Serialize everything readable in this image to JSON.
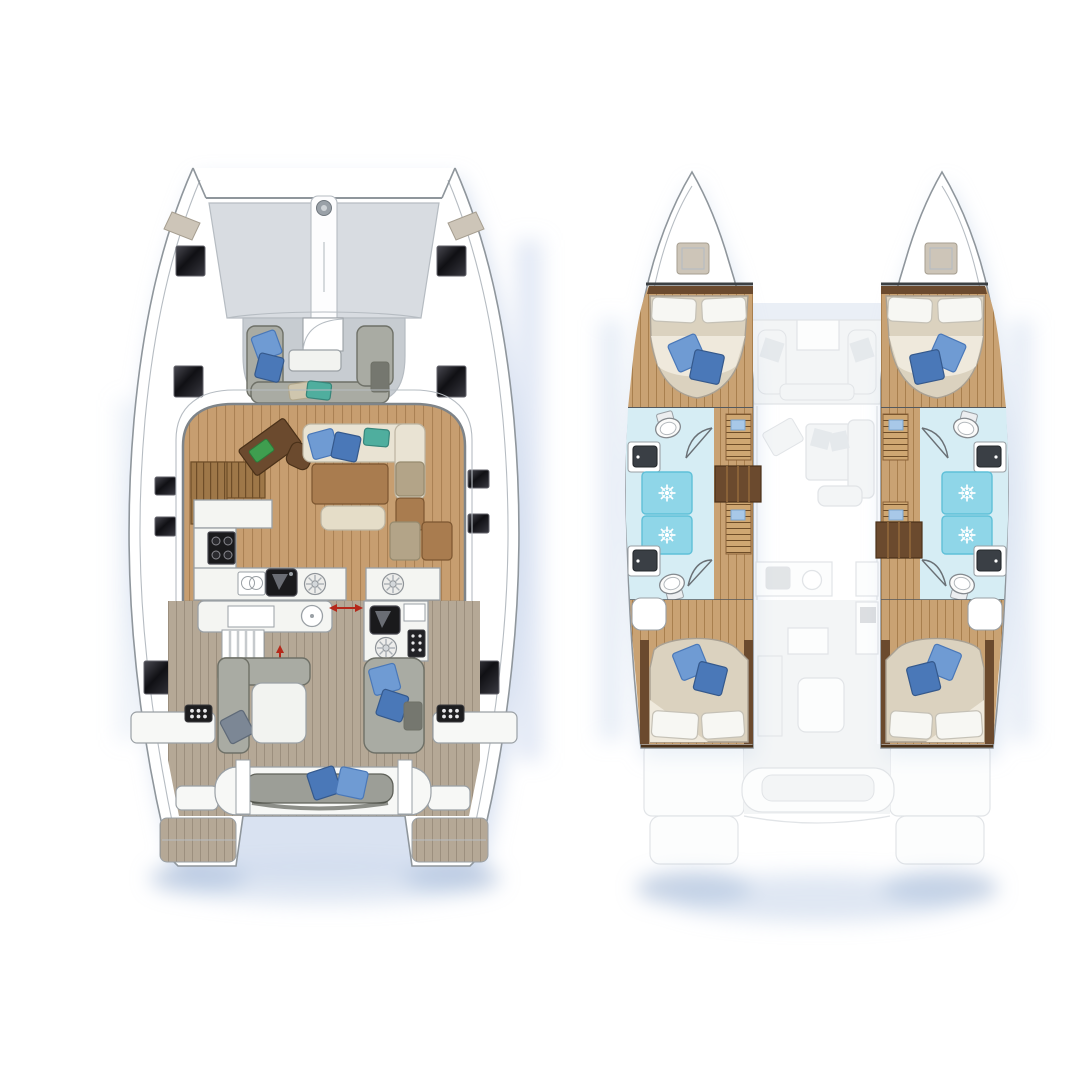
{
  "diagram": {
    "subject": "catamaran-yacht-floor-plan",
    "views": [
      {
        "name": "deck-plan",
        "position": "left",
        "areas": [
          "bow-trampoline",
          "foredeck",
          "forward-cockpit-lounge",
          "salon",
          "navigation-station",
          "galley",
          "aft-cockpit",
          "stern-swim-platforms"
        ]
      },
      {
        "name": "accommodation-plan",
        "position": "right",
        "areas": [
          "port-forward-cabin",
          "port-bathroom-shower",
          "port-aft-cabin",
          "starboard-forward-cabin",
          "starboard-bathroom-shower",
          "starboard-aft-cabin",
          "ghosted-bridge-deck"
        ]
      }
    ],
    "icons": [
      "windlass-icon",
      "bow-hatch-icon",
      "deck-hatch-icon",
      "cooktop-icon",
      "stove-burner-icon",
      "sink-icon",
      "dish-rack-icon",
      "engine-vent-grid-icon",
      "sliding-door-arrow-icon",
      "companionway-arrow-icon",
      "shower-head-starburst-icon",
      "toilet-icon",
      "vanity-sink-icon",
      "companionway-steps-icon"
    ]
  },
  "colors": {
    "page_bg": "#ffffff",
    "hull_fill": "#ffffff",
    "hull_line": "#8f969c",
    "soft_line": "#b6bcc2",
    "deck_edge": "#7e8489",
    "shadow_glow": "#bfcfe8",
    "shadow_deep": "#9fb4d4",
    "trampoline": "#d8dce1",
    "bow_locker": "#cdc5b8",
    "gray_deck": "#c7ccd1",
    "sofa_gray": "#a9aba3",
    "sofa_gray_line": "#6e7067",
    "dark_box": "#75776f",
    "table_white": "#f2f3f0",
    "pillow_blue": "#6f9bd3",
    "pillow_blue_dark": "#4a78b8",
    "pillow_teal": "#4fae9e",
    "pillow_beige": "#cfc6ae",
    "pillow_steel": "#7c8795",
    "pillow_white": "#f7f7f3",
    "wood_floor": "#c79e70",
    "wood_floor_line": "#aa8154",
    "teak_floor": "#b5a896",
    "teak_floor_line": "#9c8f7e",
    "wood_hull": "#c9a273",
    "wood_hull_line": "#a87f4e",
    "slat_wood": "#9e7748",
    "slat_wood_line": "#6e4d28",
    "louver_wood": "#cfa772",
    "wood_dark": "#6b4a2e",
    "wood_mid": "#a97c4f",
    "cream_sofa": "#e9e3d3",
    "cream_ottoman": "#e5ddc8",
    "taupe_cushion": "#b3a488",
    "counter_white": "#f4f5f2",
    "counter_line": "#9aa0a5",
    "appliance_black": "#1a1a1c",
    "arrow_red": "#b5281a",
    "bath_floor": "#d6edf4",
    "shower_cyan": "#8fd6e8",
    "shower_cyan_deep": "#5fc0d8",
    "mattress": "#dbd2bf",
    "mattress_line": "#a9a092",
    "blanket_fold": "#efe9dc",
    "ghost_fill": "#e8ebee",
    "ghost_line": "#c3c9cf",
    "chart_pad_green": "#3f9e4f"
  }
}
